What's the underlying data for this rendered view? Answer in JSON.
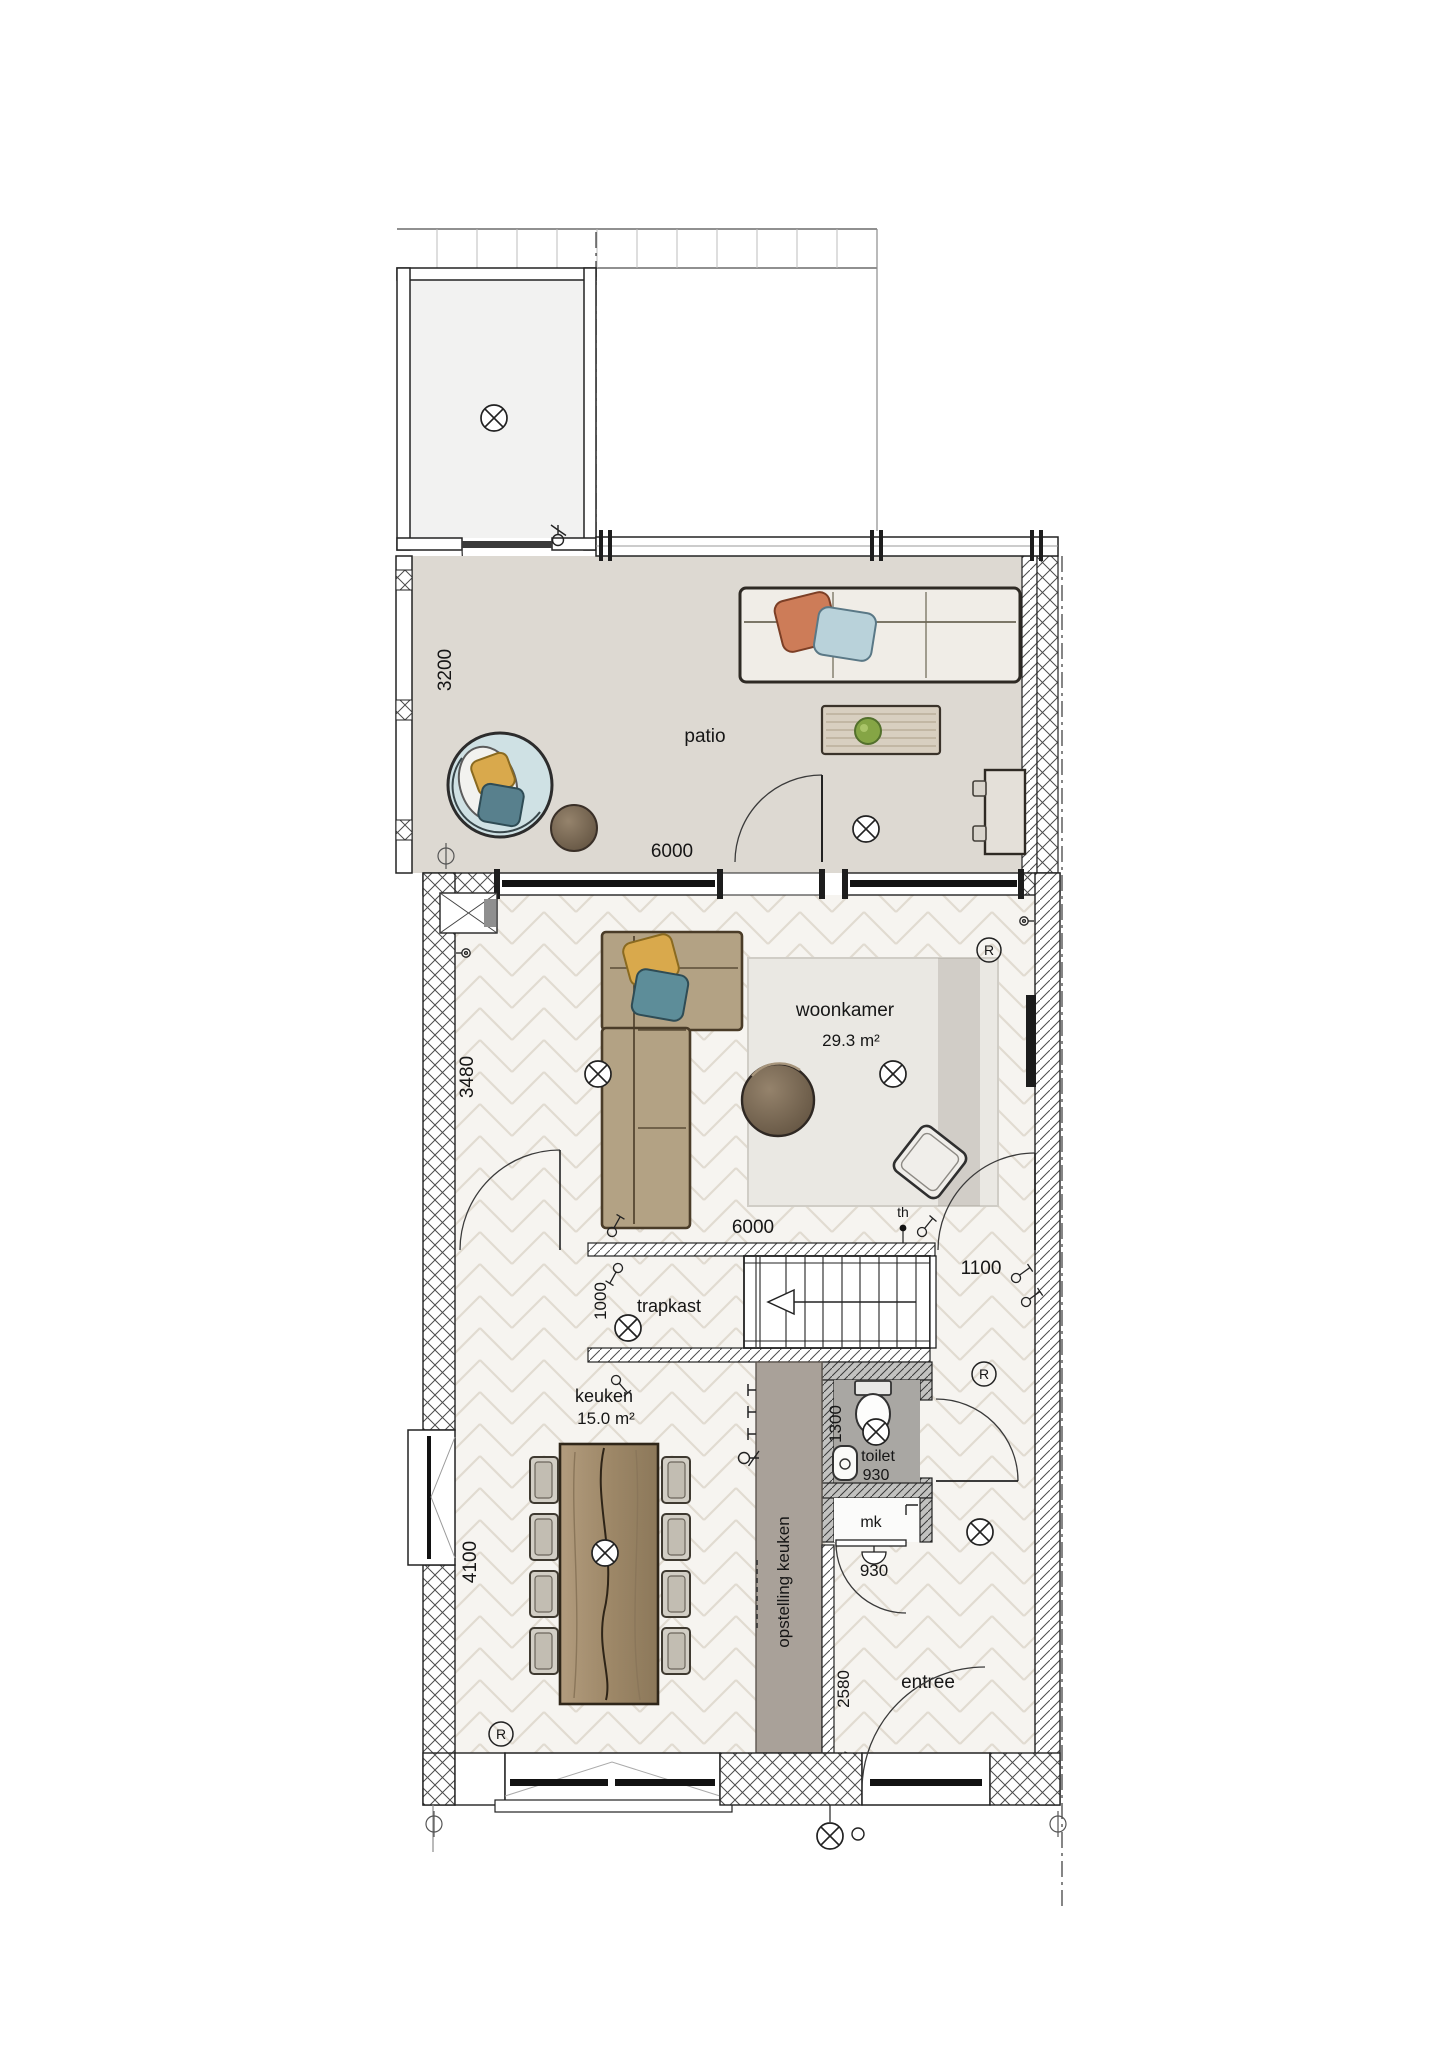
{
  "plan_type": "floor-plan",
  "rooms": {
    "patio": {
      "label": "patio"
    },
    "woonkamer": {
      "label": "woonkamer",
      "area": "29.3 m²"
    },
    "trapkast": {
      "label": "trapkast"
    },
    "keuken": {
      "label": "keuken",
      "area": "15.0 m²"
    },
    "toilet": {
      "label": "toilet",
      "width": "930"
    },
    "meterkast": {
      "label": "mk",
      "door_width": "930"
    },
    "entree": {
      "label": "entree"
    },
    "opstelling_keuken": {
      "label": "opstelling keuken"
    }
  },
  "dimensions": {
    "patio_depth": "3200",
    "patio_width": "6000",
    "woonkamer_depth": "3480",
    "woonkamer_width": "6000",
    "hal_width": "1100",
    "trapkast_opening": "1000",
    "toilet_depth": "1300",
    "keuken_depth": "4100",
    "keuken_width": "3770",
    "entree_depth": "2580"
  },
  "symbols": {
    "thermostat_label": "th",
    "detector_label": "R"
  }
}
